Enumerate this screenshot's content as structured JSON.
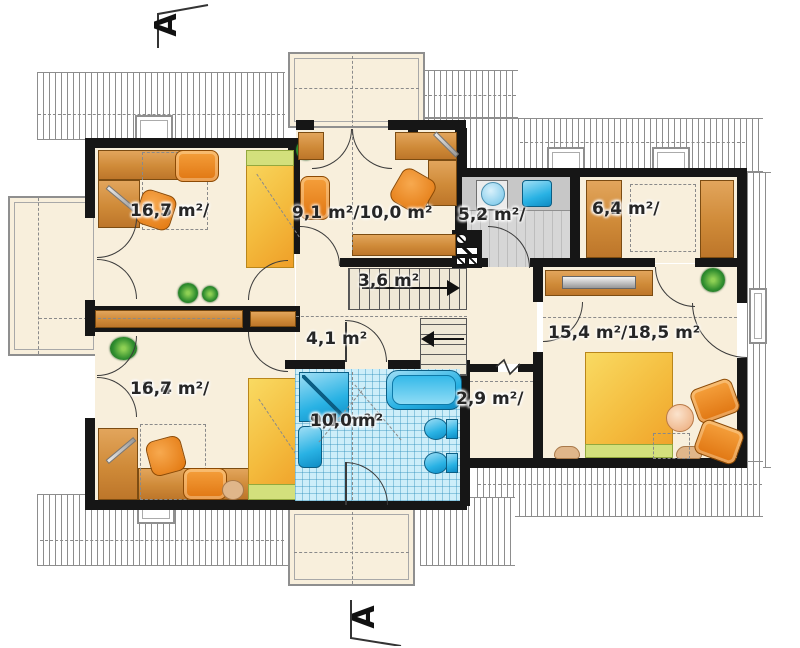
{
  "section_markers": {
    "top": "A",
    "bottom": "A"
  },
  "rooms": [
    {
      "name": "bedroom-top-left",
      "lines": [
        "13,5 m²/",
        "16,7 m²"
      ]
    },
    {
      "name": "study",
      "lines": [
        "9,1 m²/10,0 m²"
      ]
    },
    {
      "name": "utility-laundry",
      "lines": [
        "3,4 m²/",
        "5,2 m²"
      ]
    },
    {
      "name": "wardrobe",
      "lines": [
        "4,2 m²/",
        "6,4 m²"
      ]
    },
    {
      "name": "stairs",
      "lines": [
        "3,6 m²"
      ]
    },
    {
      "name": "landing",
      "lines": [
        "4,1 m²"
      ]
    },
    {
      "name": "bedroom-right",
      "lines": [
        "15,4 m²/18,5 m²"
      ]
    },
    {
      "name": "closet",
      "lines": [
        "1,9 m²/",
        "2,9 m²"
      ]
    },
    {
      "name": "bathroom",
      "lines": [
        "9,1 m²/",
        "10,0 m²"
      ]
    },
    {
      "name": "bedroom-bottom-left",
      "lines": [
        "13,4 m²/",
        "16,7 m²"
      ]
    }
  ],
  "colors": {
    "wall": "#161616",
    "floor_cream": "#f8efdc",
    "roof_hatch_line": "#8d8d8d",
    "bath_tile": "#cdeef9",
    "fixture_blue": "#29b2e4",
    "furniture_orange": "#e8811c",
    "bed_yellow": "#f4bc3e",
    "accent_green": "#d3e07c",
    "utility_gray": "#d6d6d6",
    "wood_brown": "#cd8436"
  }
}
